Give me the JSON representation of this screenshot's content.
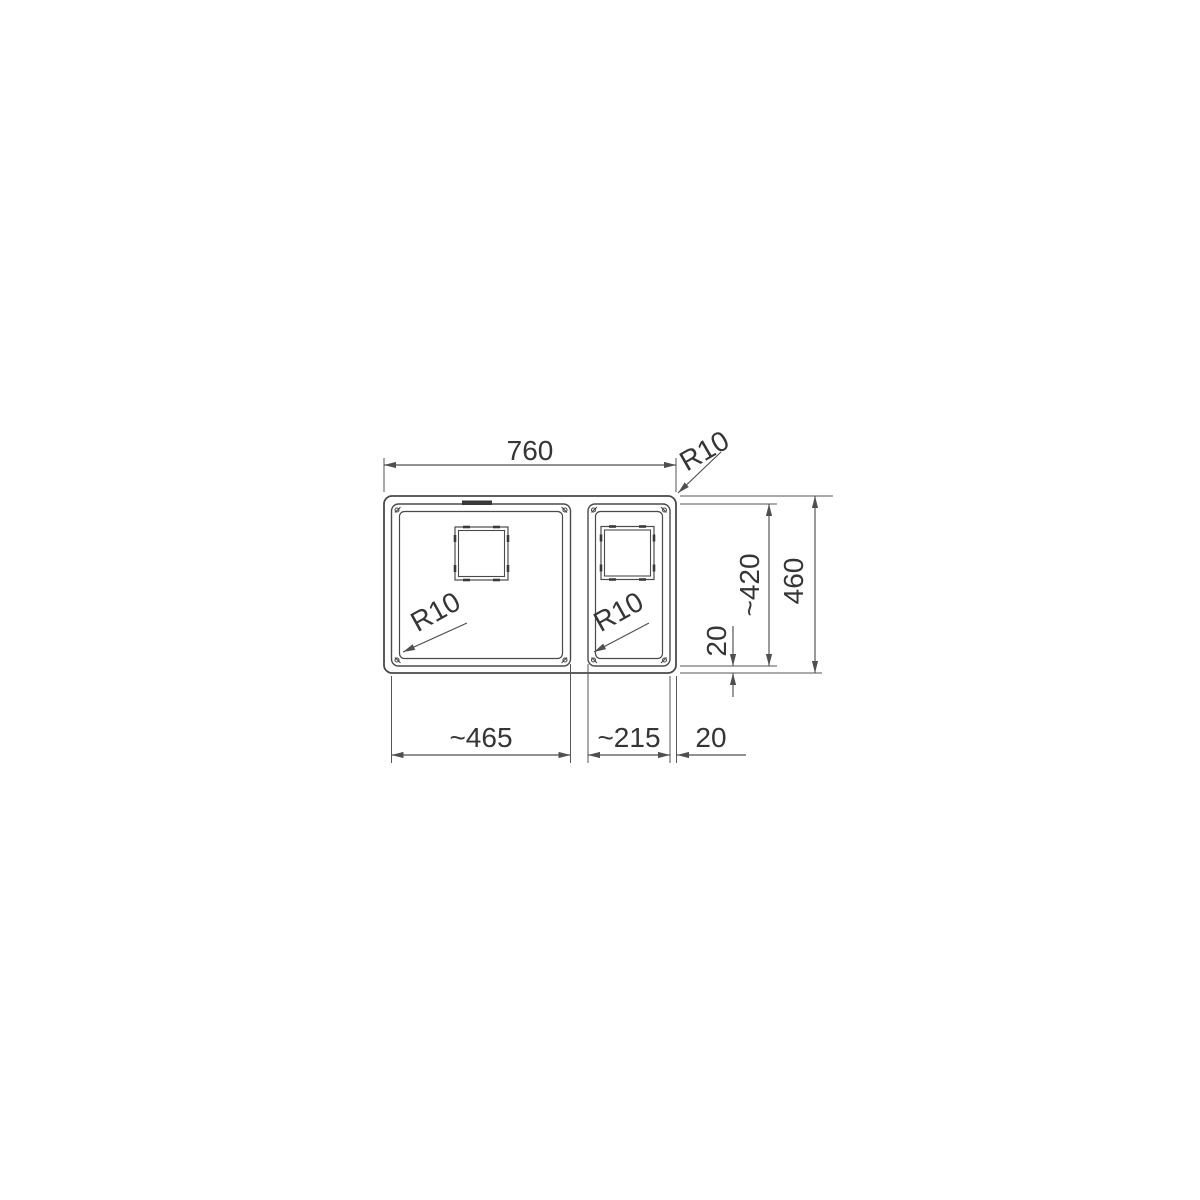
{
  "page": {
    "background": "#ffffff"
  },
  "drawing": {
    "type": "technical-drawing",
    "subject": "dual-bowl sink top view with dimensions",
    "line_color": "#4a4a4c",
    "text_color": "#353537",
    "labels": {
      "overall_width": "760",
      "outer_corner_radius": "R10",
      "overall_depth": "460",
      "inner_depth": "~420",
      "edge_offset_vertical": "20",
      "large_bowl_width": "~465",
      "small_bowl_width": "~215",
      "edge_offset_horizontal": "20",
      "large_bowl_corner_radius": "R10",
      "small_bowl_corner_radius": "R10"
    }
  }
}
